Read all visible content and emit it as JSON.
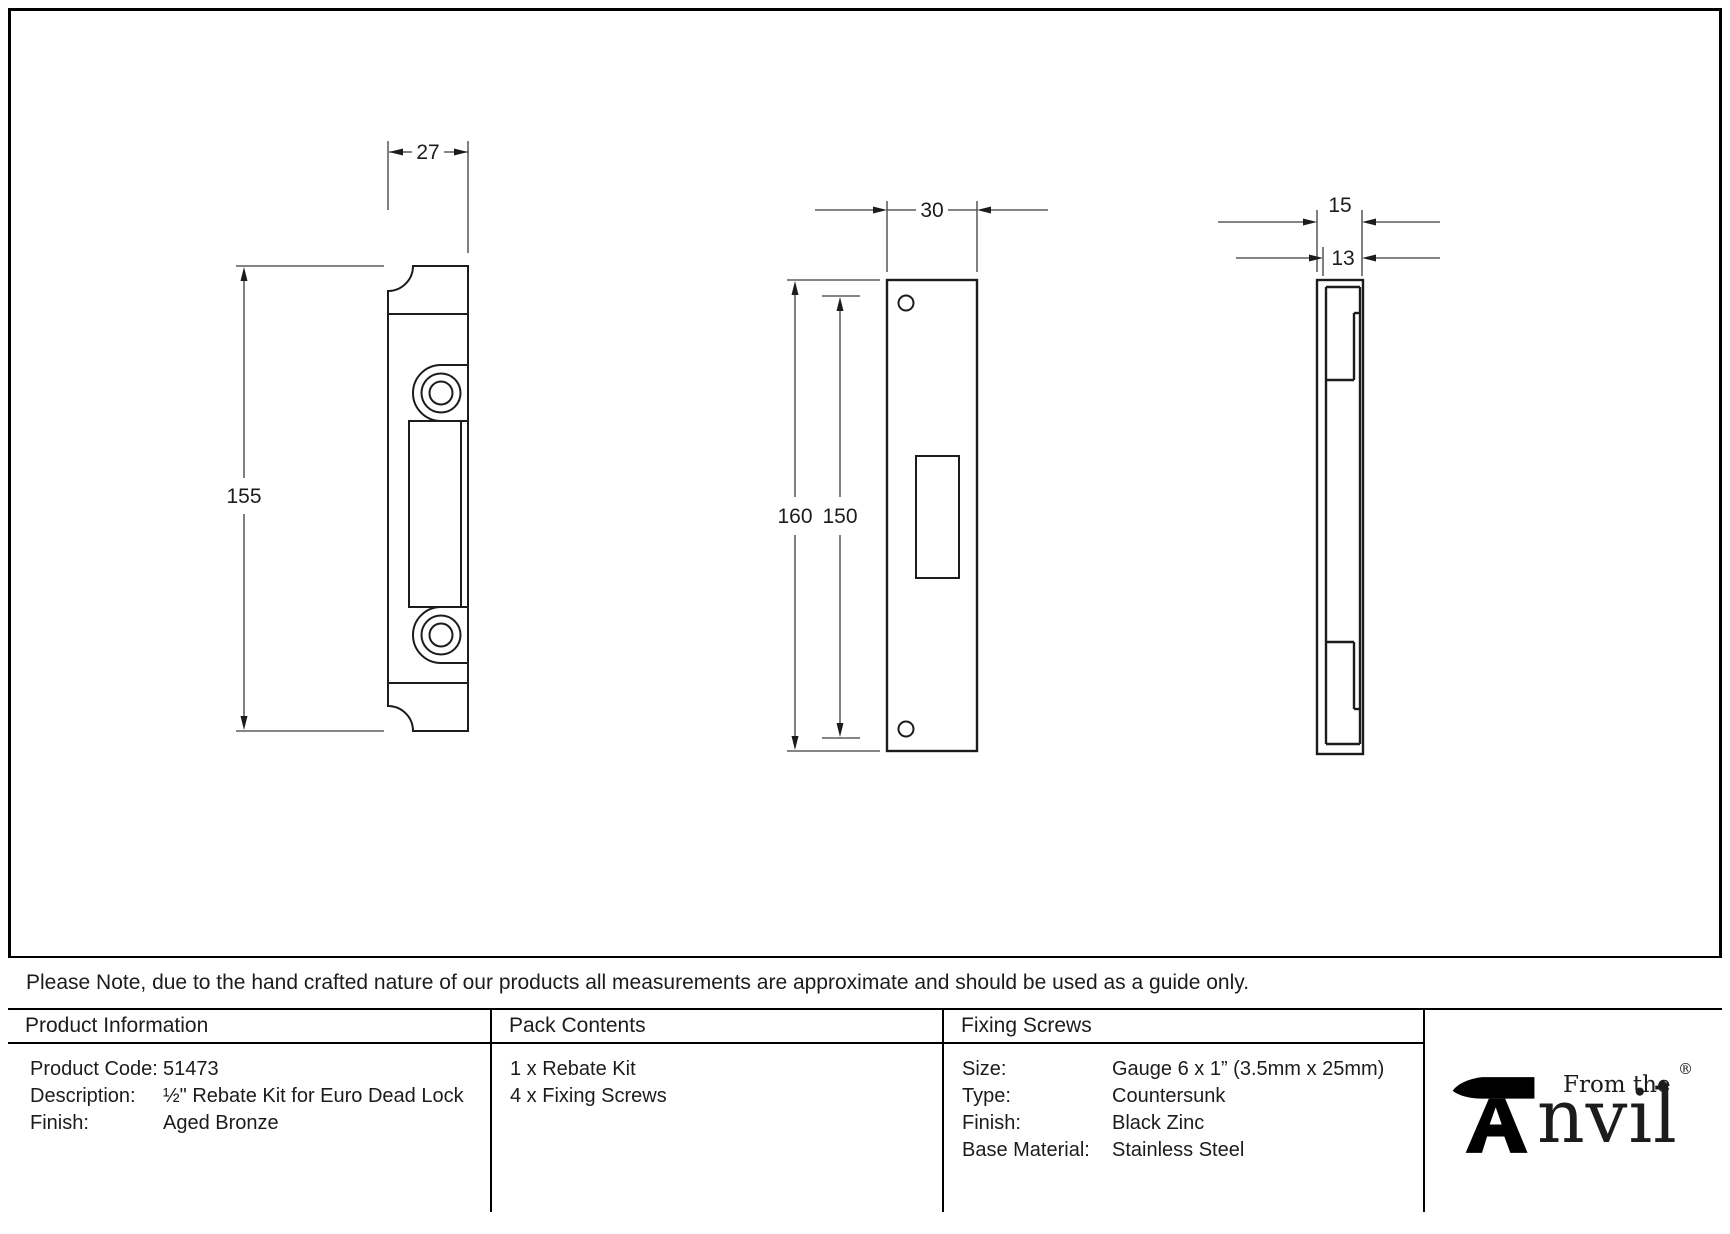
{
  "drawing": {
    "views": {
      "side_profile": {
        "width": "27",
        "height": "155"
      },
      "face_plate": {
        "width": "30",
        "height_outer": "160",
        "height_inner": "150"
      },
      "edge_profile": {
        "depth_outer": "15",
        "depth_inner": "13"
      }
    },
    "line_color": "#1c1c1c",
    "dim_color": "#3c3c3c"
  },
  "note": {
    "text": "Please Note, due to the hand crafted nature of our products all measurements are approximate and should be used as a guide only."
  },
  "table": {
    "product_information": {
      "header": "Product Information",
      "rows": [
        {
          "label": "Product Code:",
          "value": "51473"
        },
        {
          "label": "Description:",
          "value": "½\" Rebate Kit for Euro Dead Lock"
        },
        {
          "label": "Finish:",
          "value": "Aged Bronze"
        }
      ]
    },
    "pack_contents": {
      "header": "Pack Contents",
      "items": [
        "1 x Rebate Kit",
        "4 x Fixing Screws"
      ]
    },
    "fixing_screws": {
      "header": "Fixing Screws",
      "rows": [
        {
          "label": "Size:",
          "value": "Gauge 6 x 1” (3.5mm x 25mm)"
        },
        {
          "label": "Type:",
          "value": "Countersunk"
        },
        {
          "label": "Finish:",
          "value": "Black Zinc"
        },
        {
          "label": "Base Material:",
          "value": "Stainless Steel"
        }
      ]
    }
  },
  "logo": {
    "prefix": "From the",
    "diamond": "◆",
    "name_rest": "nvil",
    "registered": "®"
  }
}
